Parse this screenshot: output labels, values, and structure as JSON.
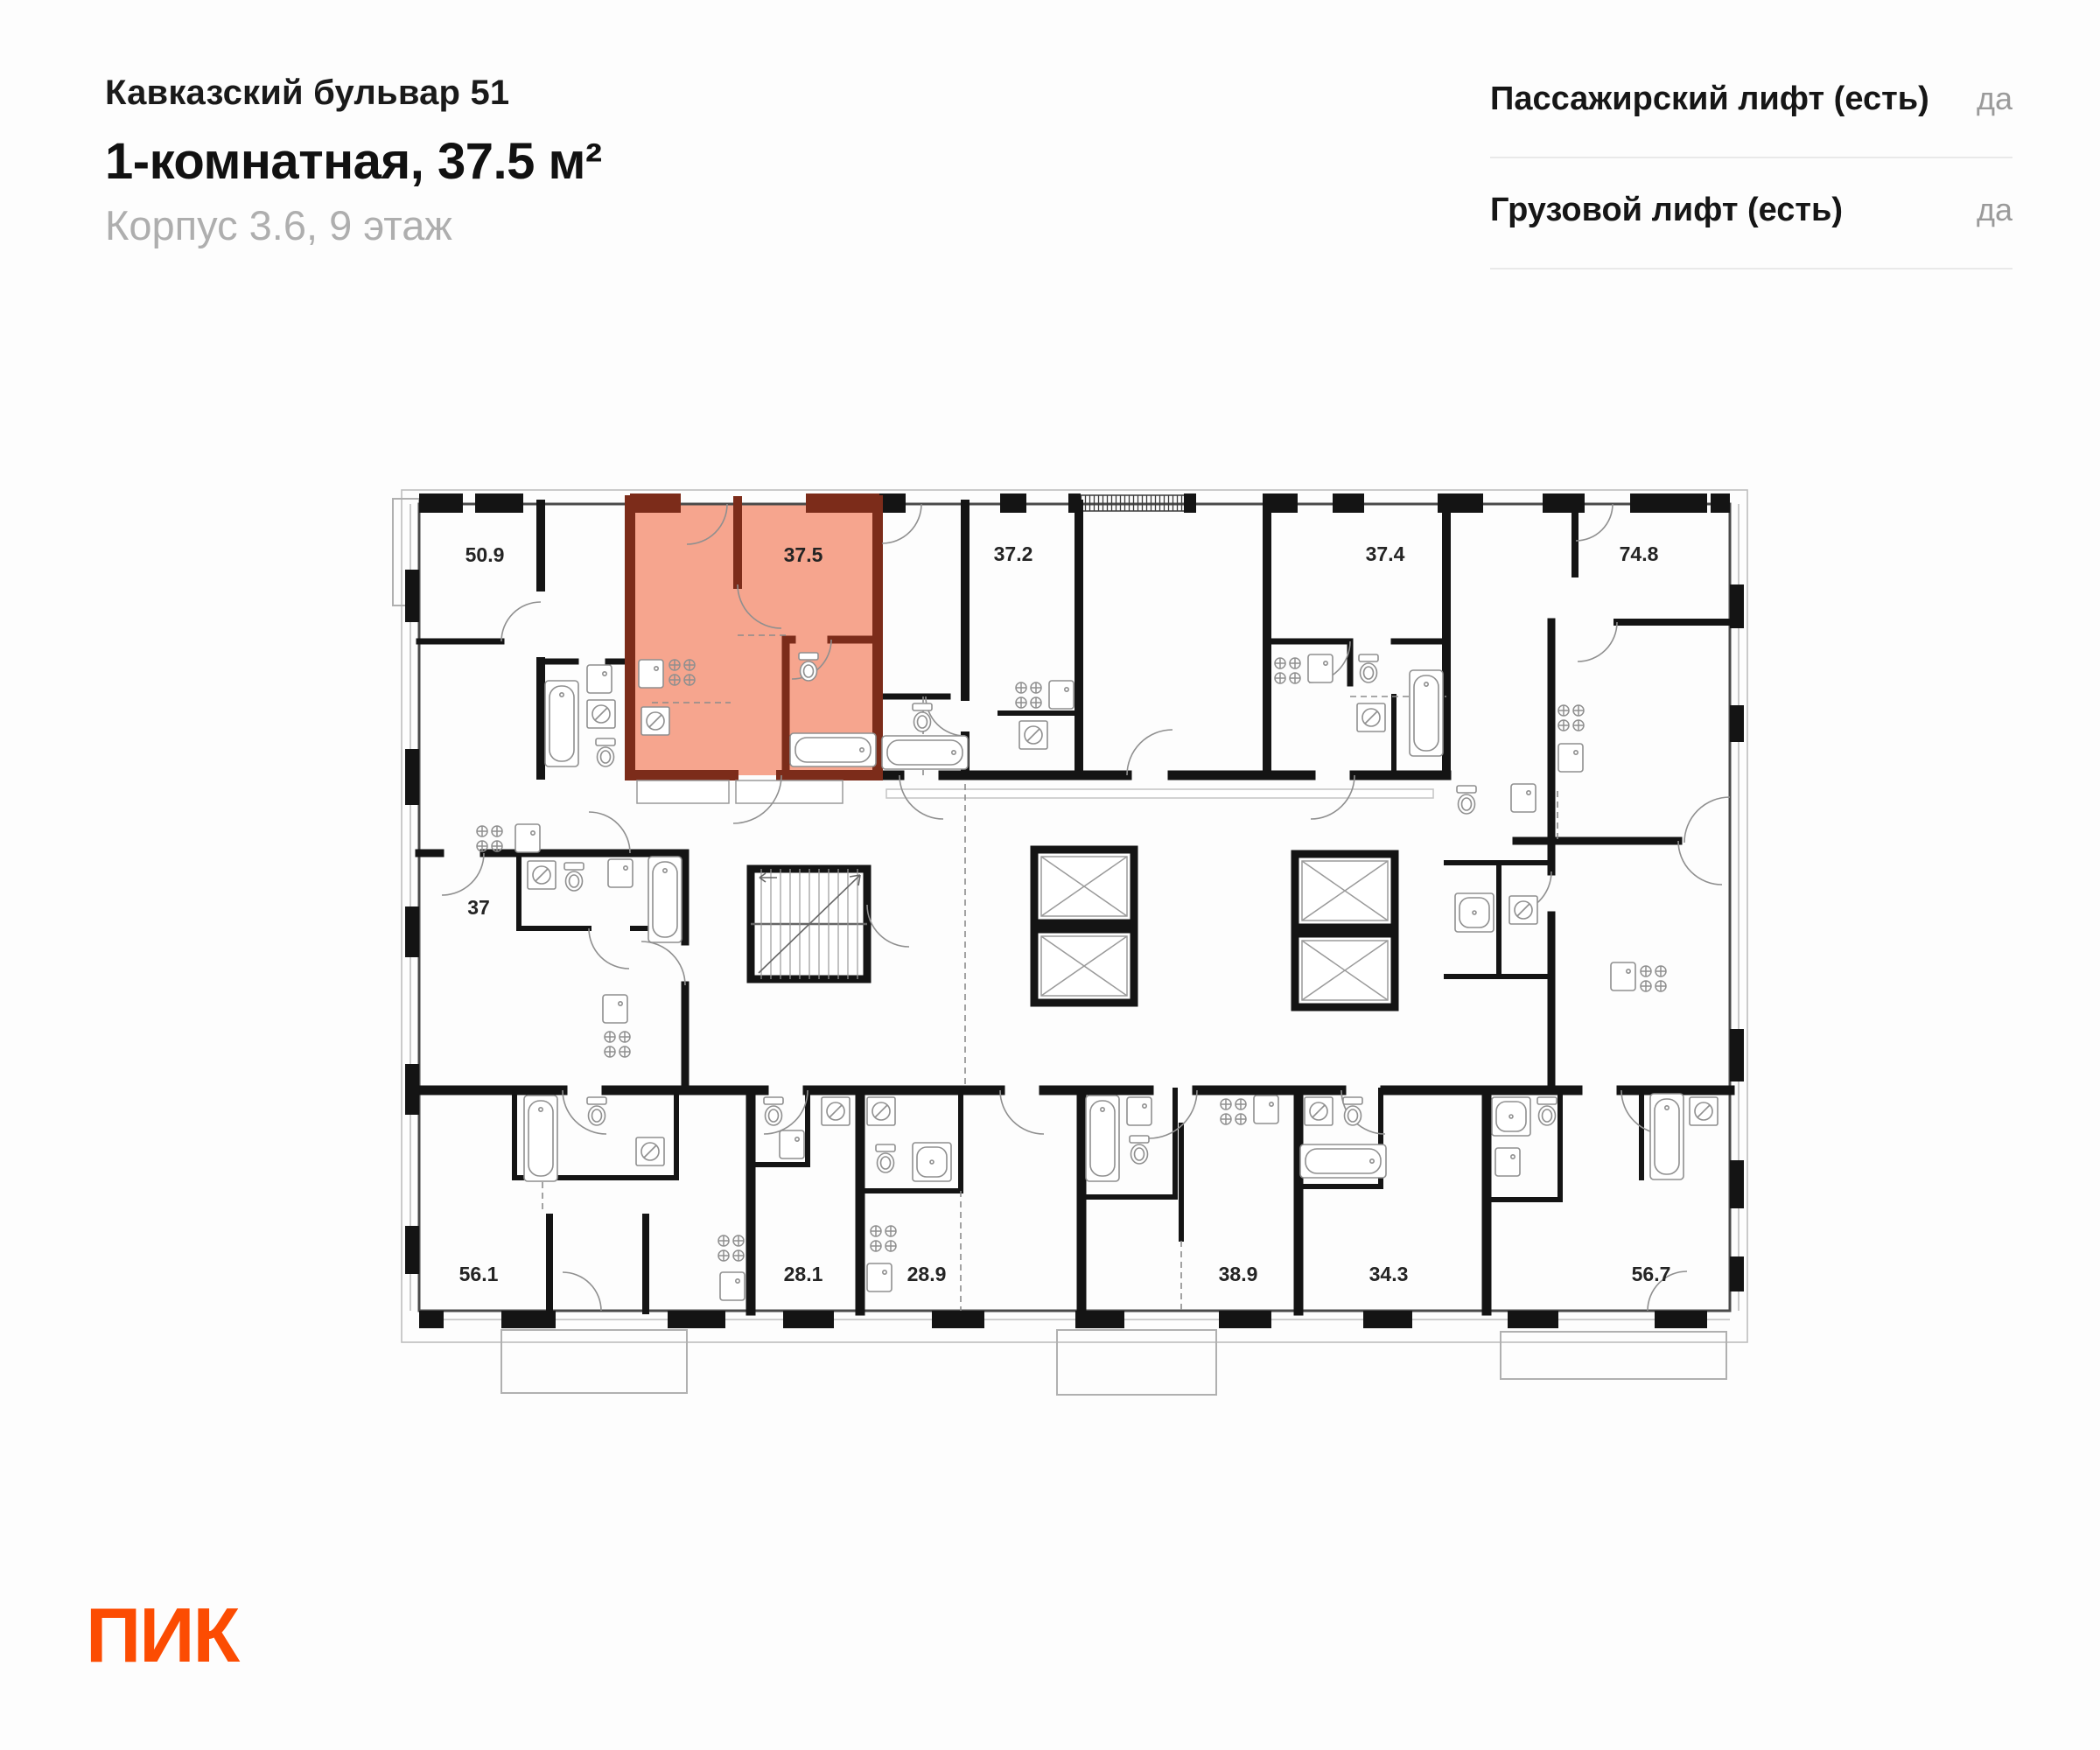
{
  "header": {
    "project": "Кавказский бульвар 51",
    "apartment": "1-комнатная, 37.5 м²",
    "location": "Корпус 3.6, 9 этаж"
  },
  "features": [
    {
      "label": "Пассажирский лифт (есть)",
      "value": "да"
    },
    {
      "label": "Грузовой лифт (есть)",
      "value": "да"
    }
  ],
  "logo_text": "ПИК",
  "brand": {
    "logo_color": "#fc4c02",
    "highlight_fill": "#f6a58e",
    "highlight_wall": "#7c2c1a",
    "wall_color": "#141414"
  },
  "plan": {
    "units": [
      {
        "area": "50.9"
      },
      {
        "area": "37.5",
        "highlighted": true
      },
      {
        "area": "37.2"
      },
      {
        "area": "37.4"
      },
      {
        "area": "74.8"
      },
      {
        "area": "37"
      },
      {
        "area": "56.1"
      },
      {
        "area": "28.1"
      },
      {
        "area": "28.9"
      },
      {
        "area": "38.9"
      },
      {
        "area": "34.3"
      },
      {
        "area": "56.7"
      }
    ]
  }
}
